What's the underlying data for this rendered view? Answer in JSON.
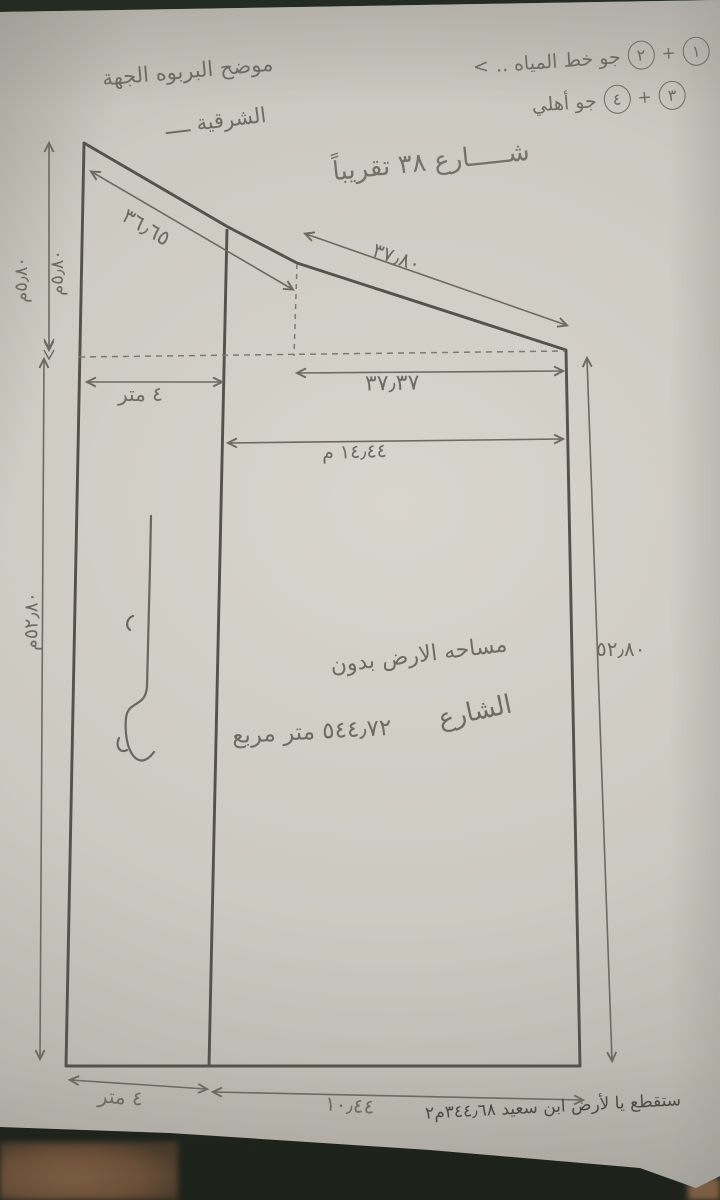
{
  "annotations": {
    "top_left_line1": "موضح البربوه الجهة",
    "top_left_line2": "الشرقية ــــ",
    "eq1_n1": "١",
    "eq1_plus": "+",
    "eq1_n2": "٢",
    "eq1_text": "جو خط المياه ..",
    "eq1_mark": "<",
    "eq2_n1": "٣",
    "eq2_plus": "+",
    "eq2_n2": "٤",
    "eq2_text": "جو أهلي",
    "street": "شـــــارع ٣٨ تقريباً",
    "area_line1": "مساحه الارض بدون",
    "area_word": "الشارع",
    "area_value": "٥٤٤٫٧٢ متر مربع",
    "bottom_note": "ستقطع يا لأرض ابن سعيد ٣٤٤٫٦٨م٢"
  },
  "dims": {
    "slope_left": "٣٦٫٦٥",
    "slope_right": "٣٧٫٨٠",
    "width_3737": "٣٧٫٣٧",
    "strip_width": "٤ متر",
    "width_1444": "١٤٫٤٤ م",
    "left_upper_a": "٥٫٨٠م",
    "left_upper_b": "٥٫٨٠م",
    "left_lower": "٥٢٫٨٠م",
    "right_side": "٥٢٫٨٠",
    "bottom_strip": "٤ متر",
    "bottom_main": "١٠٫٤٤"
  },
  "colors": {
    "paper": "#ccc9c1",
    "pencil": "#6f6b63",
    "outline": "#56524b",
    "ink_note": "#4e4a43",
    "floor_dark": "#1d231b",
    "floor_brown": "#6b4f38"
  }
}
